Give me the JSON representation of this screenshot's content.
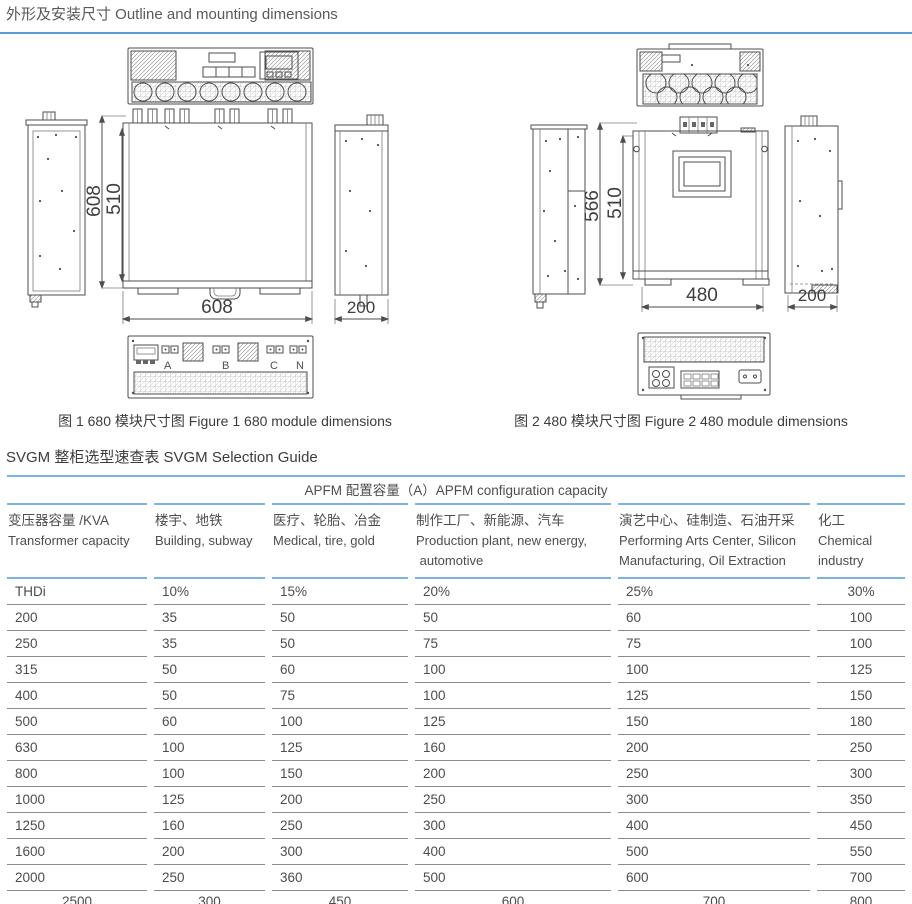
{
  "page": {
    "title": "外形及安装尺寸 Outline and mounting dimensions",
    "section_title": "SVGM 整柜选型速查表 SVGM Selection Guide"
  },
  "figures": {
    "fig1": {
      "caption": "图 1  680 模块尺寸图 Figure 1 680 module dimensions",
      "dims": {
        "height_outer": "608",
        "height_inner": "510",
        "width": "608",
        "depth": "200"
      },
      "terminals": [
        "A",
        "B",
        "C",
        "N"
      ]
    },
    "fig2": {
      "caption": "图 2 480 模块尺寸图 Figure 2 480 module dimensions",
      "dims": {
        "height_outer": "566",
        "height_inner": "510",
        "width": "480",
        "depth": "200"
      }
    }
  },
  "table": {
    "merged_header": "APFM 配置容量（A）APFM configuration capacity",
    "columns": [
      {
        "zh": "变压器容量 /KVA",
        "en": "Transformer capacity",
        "en2": ""
      },
      {
        "zh": "楼宇、地铁",
        "en": "Building, subway",
        "en2": ""
      },
      {
        "zh": "医疗、轮胎、冶金",
        "en": "Medical, tire, gold",
        "en2": ""
      },
      {
        "zh": "制作工厂、新能源、汽车",
        "en": "Production plant, new energy,",
        "en2": " automotive"
      },
      {
        "zh": "演艺中心、硅制造、石油开采",
        "en": "Performing Arts Center, Silicon",
        "en2": "Manufacturing, Oil Extraction"
      },
      {
        "zh": "化工",
        "en": "Chemical",
        "en2": "industry"
      }
    ],
    "rows": [
      [
        "THDi",
        "10%",
        "15%",
        "20%",
        "25%",
        "30%"
      ],
      [
        "200",
        "35",
        "50",
        "50",
        "60",
        "100"
      ],
      [
        "250",
        "35",
        "50",
        "75",
        "75",
        "100"
      ],
      [
        "315",
        "50",
        "60",
        "100",
        "100",
        "125"
      ],
      [
        "400",
        "50",
        "75",
        "100",
        "125",
        "150"
      ],
      [
        "500",
        "60",
        "100",
        "125",
        "150",
        "180"
      ],
      [
        "630",
        "100",
        "125",
        "160",
        "200",
        "250"
      ],
      [
        "800",
        "100",
        "150",
        "200",
        "250",
        "300"
      ],
      [
        "1000",
        "125",
        "200",
        "250",
        "300",
        "350"
      ],
      [
        "1250",
        "160",
        "250",
        "300",
        "400",
        "450"
      ],
      [
        "1600",
        "200",
        "300",
        "400",
        "500",
        "550"
      ],
      [
        "2000",
        "250",
        "360",
        "500",
        "600",
        "700"
      ]
    ],
    "footer_row": [
      "2500",
      "300",
      "450",
      "600",
      "700",
      "800"
    ]
  }
}
